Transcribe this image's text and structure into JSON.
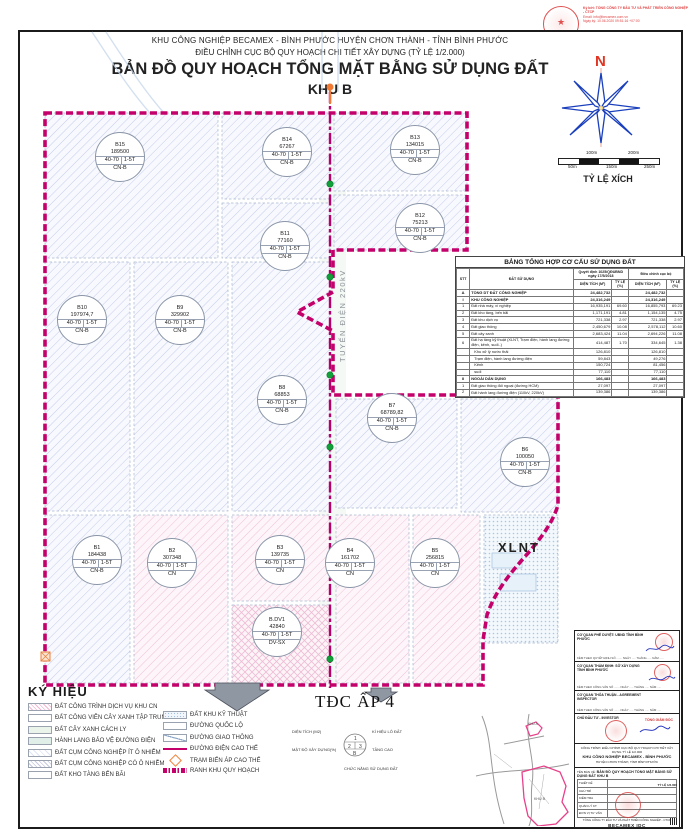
{
  "header": {
    "line1": "KHU CÔNG NGHIỆP BECAMEX - BÌNH PHƯỚC HUYỆN CHƠN THÀNH - TỈNH BÌNH PHƯỚC",
    "line2": "ĐIỀU CHỈNH CỤC BỘ QUY HOẠCH CHI TIẾT XÂY DỰNG (TỶ LỆ 1/2.000)",
    "main_title": "BẢN ĐỒ QUY HOẠCH TỔNG MẶT BẰNG SỬ DỤNG ĐẤT",
    "subtitle": "KHU B"
  },
  "digital_signature": {
    "line1": "Ký bởi: TỔNG CÔNG TY ĐẦU TƯ VÀ PHÁT TRIỂN CÔNG NGHIỆP - CTCP",
    "line2": "Email: info@becamex.com.vn",
    "line3": "Ngày ký: 10.06.2020 09:51:16 +07:00"
  },
  "compass": {
    "north": "N"
  },
  "scale_bar": {
    "title": "TỶ LỆ XÍCH",
    "top_labels": [
      "100m",
      "200m"
    ],
    "bottom_labels": [
      "50m",
      "150m",
      "250m"
    ]
  },
  "map": {
    "power_line_label": "TUYẾN ĐIỆN 220kV",
    "tdc_label": "TĐC ẤP 4",
    "xlnt_label": "XLNT",
    "colors": {
      "boundary": "#c4006a",
      "power_line": "#b5006b",
      "green_marker": "#12a03a",
      "substation_orange": "#f07a35"
    },
    "parcels": [
      {
        "id": "B15",
        "area": "189500",
        "density": "40-70",
        "floors": "1-5T",
        "use": "CN-B",
        "x": 95,
        "y": 132
      },
      {
        "id": "B14",
        "area": "67267",
        "density": "40-70",
        "floors": "1-5T",
        "use": "CN-B",
        "x": 262,
        "y": 127
      },
      {
        "id": "B13",
        "area": "134015",
        "density": "40-70",
        "floors": "1-5T",
        "use": "CN-B",
        "x": 390,
        "y": 125
      },
      {
        "id": "B12",
        "area": "75213",
        "density": "40-70",
        "floors": "1-5T",
        "use": "CN-B",
        "x": 395,
        "y": 203
      },
      {
        "id": "B11",
        "area": "77160",
        "density": "40-70",
        "floors": "1-5T",
        "use": "CN-B",
        "x": 260,
        "y": 221
      },
      {
        "id": "B10",
        "area": "197974,7",
        "density": "40-70",
        "floors": "1-5T",
        "use": "CN-B",
        "x": 57,
        "y": 295
      },
      {
        "id": "B9",
        "area": "329902",
        "density": "40-70",
        "floors": "1-5T",
        "use": "CN-B",
        "x": 155,
        "y": 295
      },
      {
        "id": "B8",
        "area": "68853",
        "density": "40-70",
        "floors": "1-5T",
        "use": "CN-B",
        "x": 257,
        "y": 375
      },
      {
        "id": "B7",
        "area": "68789,82",
        "density": "40-70",
        "floors": "1-5T",
        "use": "CN-B",
        "x": 367,
        "y": 393
      },
      {
        "id": "B6",
        "area": "100050",
        "density": "40-70",
        "floors": "1-5T",
        "use": "CN-B",
        "x": 500,
        "y": 437
      },
      {
        "id": "B1",
        "area": "184438",
        "density": "40-70",
        "floors": "1-5T",
        "use": "CN-B",
        "x": 72,
        "y": 535
      },
      {
        "id": "B2",
        "area": "307348",
        "density": "40-70",
        "floors": "1-5T",
        "use": "CN",
        "x": 147,
        "y": 538
      },
      {
        "id": "B3",
        "area": "139735",
        "density": "40-70",
        "floors": "1-5T",
        "use": "CN",
        "x": 255,
        "y": 535
      },
      {
        "id": "B4",
        "area": "161702",
        "density": "40-70",
        "floors": "1-5T",
        "use": "CN",
        "x": 325,
        "y": 538
      },
      {
        "id": "B5",
        "area": "256815",
        "density": "40-70",
        "floors": "1-5T",
        "use": "CN",
        "x": 410,
        "y": 538
      },
      {
        "id": "B.DV1",
        "area": "42840",
        "density": "40-70",
        "floors": "1-5T",
        "use": "DV-SX",
        "x": 252,
        "y": 607
      }
    ]
  },
  "table": {
    "title": "BẢNG TỔNG HỢP CƠ CẤU SỬ DỤNG ĐẤT",
    "col_stt": "STT",
    "col_use": "ĐẤT SỬ DỤNG",
    "col_decision": "Quyết định 1025/QĐUBND ngày 17/5/2018",
    "col_adjust": "Điều chỉnh cục bộ",
    "sub_area": "DIỆN TÍCH (M²)",
    "sub_ratio": "TỶ LỆ (%)",
    "rows": [
      {
        "stt": "A",
        "name": "TỔNG DT ĐẤT CÔNG NGHIỆP",
        "a1": "24,482,732",
        "r1": "",
        "a2": "24,482,732",
        "r2": "",
        "cls": "b"
      },
      {
        "stt": "I",
        "name": "KHU CÔNG NGHIỆP",
        "a1": "24,316,249",
        "r1": "",
        "a2": "24,316,249",
        "r2": "",
        "cls": "b"
      },
      {
        "stt": "1",
        "name": "Đất nhà máy, xí nghiệp",
        "a1": "16,935,191",
        "r1": "69.60",
        "a2": "16,855,793",
        "r2": "69.23"
      },
      {
        "stt": "2",
        "name": "Đất kho tàng, bến bãi",
        "a1": "1,171,191",
        "r1": "4.81",
        "a2": "1,154,135",
        "r2": "4.75"
      },
      {
        "stt": "3",
        "name": "Đất khu dịch vụ",
        "a1": "721,338",
        "r1": "2.97",
        "a2": "721,338",
        "r2": "2.97"
      },
      {
        "stt": "4",
        "name": "Đất giao thông",
        "a1": "2,450,679",
        "r1": "10.08",
        "a2": "2,578,112",
        "r2": "10.60"
      },
      {
        "stt": "5",
        "name": "Đất cây xanh",
        "a1": "2,683,424",
        "r1": "11.04",
        "a2": "2,694,226",
        "r2": "11.08"
      },
      {
        "stt": "6",
        "name": "Đất hạ tầng kỹ thuật (XLNT, Trạm điện, hành lang đường điện, kênh, suối..)",
        "a1": "414,487",
        "r1": "1.70",
        "a2": "334,645",
        "r2": "1.38"
      },
      {
        "stt": "",
        "name": "Khu xử lý nước thải",
        "a1": "126,810",
        "r1": "",
        "a2": "126,810",
        "r2": "",
        "cls": "i"
      },
      {
        "stt": "",
        "name": "Trạm điện, hành lang đường điện",
        "a1": "59,843",
        "r1": "",
        "a2": "49,276",
        "r2": "",
        "cls": "i"
      },
      {
        "stt": "",
        "name": "Kênh",
        "a1": "150,724",
        "r1": "",
        "a2": "81,456",
        "r2": "",
        "cls": "i"
      },
      {
        "stt": "",
        "name": "suối",
        "a1": "77,110",
        "r1": "",
        "a2": "77,110",
        "r2": "",
        "cls": "i"
      },
      {
        "stt": "II",
        "name": "NGOÀI DÂN DỤNG",
        "a1": "166,483",
        "r1": "",
        "a2": "166,483",
        "r2": "",
        "cls": "b"
      },
      {
        "stt": "1",
        "name": "Đất giao thông đối ngoại (đường HCM)",
        "a1": "27,097",
        "r1": "",
        "a2": "27,097",
        "r2": ""
      },
      {
        "stt": "2",
        "name": "Đất hành lang đường điện (110kV, 220kV)",
        "a1": "139,386",
        "r1": "",
        "a2": "139,386",
        "r2": ""
      }
    ]
  },
  "legend": {
    "title": "KÝ HIỆU",
    "left": [
      {
        "label": "ĐẤT CÔNG TRÌNH DỊCH VỤ  KHU CN",
        "sw": "sw-pinkhatch"
      },
      {
        "label": "ĐẤT CÔNG VIÊN CÂY XANH TẬP TRUNG",
        "sw": "sw-white"
      },
      {
        "label": "ĐẤT CÂY XANH CÁCH LY",
        "sw": "sw-green"
      },
      {
        "label": "HÀNH LANG BẢO VỆ ĐƯỜNG ĐIỆN",
        "sw": "sw-mint"
      },
      {
        "label": "ĐẤT CỤM CÔNG NGHIỆP ÍT Ô NHIỄM",
        "sw": "sw-bluefaint"
      },
      {
        "label": "ĐẤT CỤM CÔNG NGHIỆP CÓ Ô NHIỄM",
        "sw": "sw-greyhatch"
      },
      {
        "label": "ĐẤT KHO TÀNG BẾN BÃI",
        "sw": "sw-white"
      }
    ],
    "right": [
      {
        "label": "ĐẤT KHU  KỸ THUẬT",
        "sw": "sw-dots"
      },
      {
        "label": "ĐƯỜNG QUỐC LỘ",
        "sw": "sw-white"
      },
      {
        "label": "ĐƯỜNG GIAO THÔNG",
        "sw": "sw-roadline"
      },
      {
        "label": "ĐƯỜNG ĐIỆN CAO THẾ",
        "sw": "sw-power"
      },
      {
        "label": "TRẠM BIẾN ÁP CAO THẾ",
        "sw": "sw-diamond"
      },
      {
        "label": "RANH KHU QUY HOẠCH",
        "sw": "sw-ranh"
      }
    ]
  },
  "parcel_key": {
    "area": "DIỆN TÍCH (M2)",
    "symbol": "KÍ HIỆU LÔ ĐẤT",
    "density": "MẬT ĐỘ XÂY DỰNG(%)",
    "floors": "TẦNG CAO",
    "func": "CHỨC NĂNG SỬ DỤNG ĐẤT",
    "n1": "1",
    "n2": "2",
    "n3": "3",
    "nb": "B"
  },
  "locator": {
    "zone_a": "KHU A",
    "zone_b": "KHU B"
  },
  "title_block": {
    "approve_label": "CƠ QUAN PHÊ DUYỆT: UBND TỈNH BÌNH PHƯỚC",
    "approve_note": "KÈM THEO QUYẾT ĐỊNH SỐ ....... NGÀY ..... THÁNG ..... NĂM .....",
    "appraise_label": "CƠ QUAN THẨM ĐỊNH: SỞ XÂY DỰNG TỈNH BÌNH PHƯỚC",
    "appraise_note": "KÈM THEO CÔNG VĂN SỐ ....... NGÀY ..... THÁNG ..... NĂM .....",
    "agree_label": "CƠ QUAN THỎA THUẬN - AGREEMENT INSPECTOR",
    "agree_note": "KÈM THEO CÔNG VĂN SỐ ....... NGÀY ..... THÁNG ..... NĂM .....",
    "investor_label": "CHỦ ĐẦU TƯ - INVESTOR",
    "investor_role": "TỔNG GIÁM ĐỐC",
    "project_label": "CÔNG TRÌNH: ĐIỀU CHỈNH CỤC BỘ QUY HOẠCH CHI TIẾT XÂY DỰNG TỶ LỆ 1/2.000",
    "project_name": "KHU CÔNG NGHIỆP BECAMEX - BÌNH PHƯỚC",
    "project_loc": "HUYỆN CHƠN THÀNH, TỈNH BÌNH PHƯỚC",
    "drawing_label": "TÊN BẢN VẼ:",
    "drawing_name": "BẢN ĐỒ QUY HOẠCH TỔNG MẶT BẰNG SỬ DỤNG ĐẤT KHU B",
    "scale_label": "TỶ LỆ 1/2.000",
    "personnel": [
      {
        "role": "THIẾT KẾ"
      },
      {
        "role": "CHỦ TRÌ"
      },
      {
        "role": "KIỂM TRA"
      },
      {
        "role": "QUẢN LÝ KT"
      },
      {
        "role": "ĐƠN VỊ TƯ VẤN"
      }
    ],
    "company": "TỔNG CÔNG TY ĐẦU TƯ VÀ PHÁT TRIỂN CÔNG NGHIỆP - CTCP",
    "company_short": "BECAMEX IDC"
  }
}
